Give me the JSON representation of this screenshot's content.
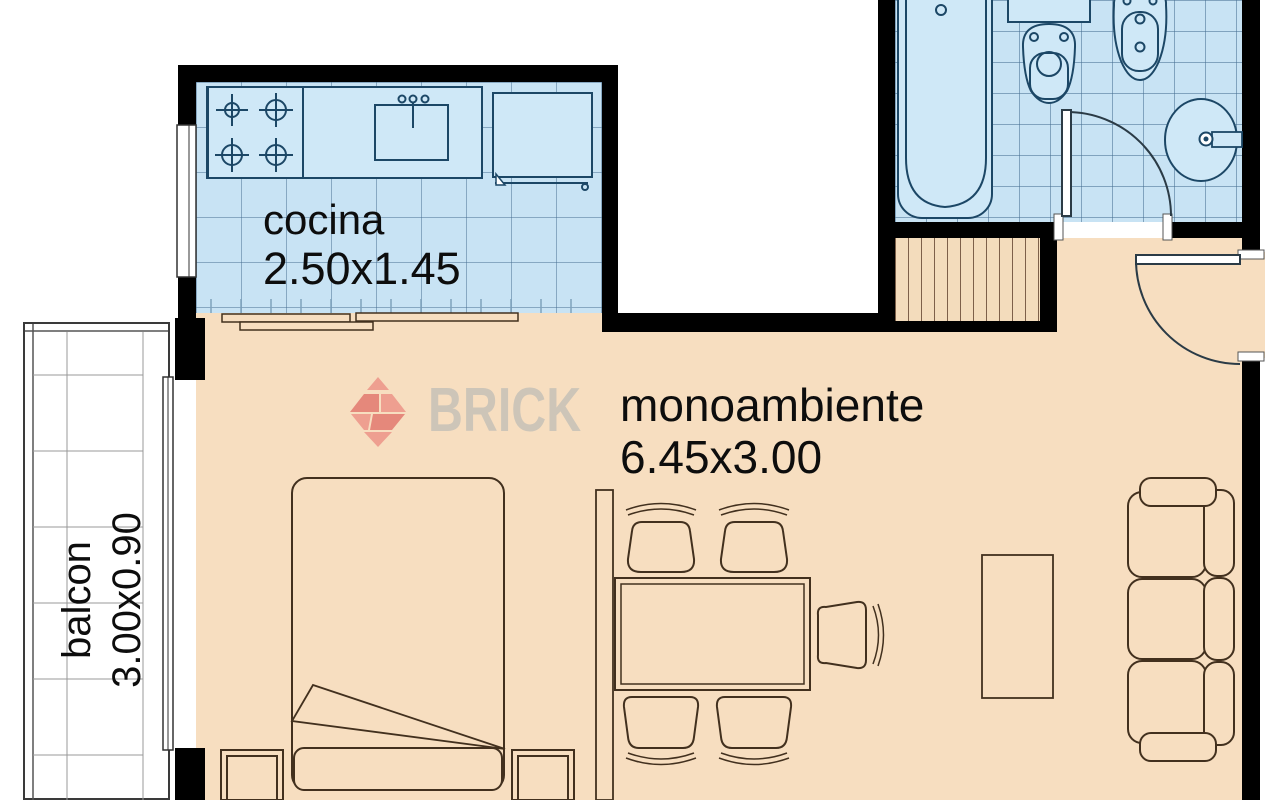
{
  "watermark": {
    "brand": "BRICK"
  },
  "rooms": {
    "kitchen": {
      "label": "cocina",
      "dimensions": "2.50x1.45"
    },
    "studio": {
      "label": "monoambiente",
      "dimensions": "6.45x3.00"
    },
    "balcony": {
      "label": "balcon",
      "dimensions": "3.00x0.90"
    },
    "bathroom": {
      "label": ""
    },
    "closet": {
      "label": ""
    }
  },
  "fixtures": [
    "bathtub",
    "toilet",
    "bidet",
    "washbasin",
    "stove",
    "kitchen-sink",
    "refrigerator",
    "kitchen-counter",
    "bed",
    "nightstand",
    "dining-table",
    "dining-chair",
    "desk-chair",
    "sofa",
    "tv-stand",
    "closet",
    "entrance-door",
    "bathroom-door",
    "sliding-partition",
    "balcony-window",
    "kitchen-window"
  ],
  "colors": {
    "wall": "#000000",
    "dry_floor": "#f7dec0",
    "wet_floor": "#c8e3f4",
    "fixture_line": "#1c4766",
    "furniture_line": "#42301e",
    "logo_red": "#ec9e90",
    "logo_text": "#cdc5b8"
  }
}
